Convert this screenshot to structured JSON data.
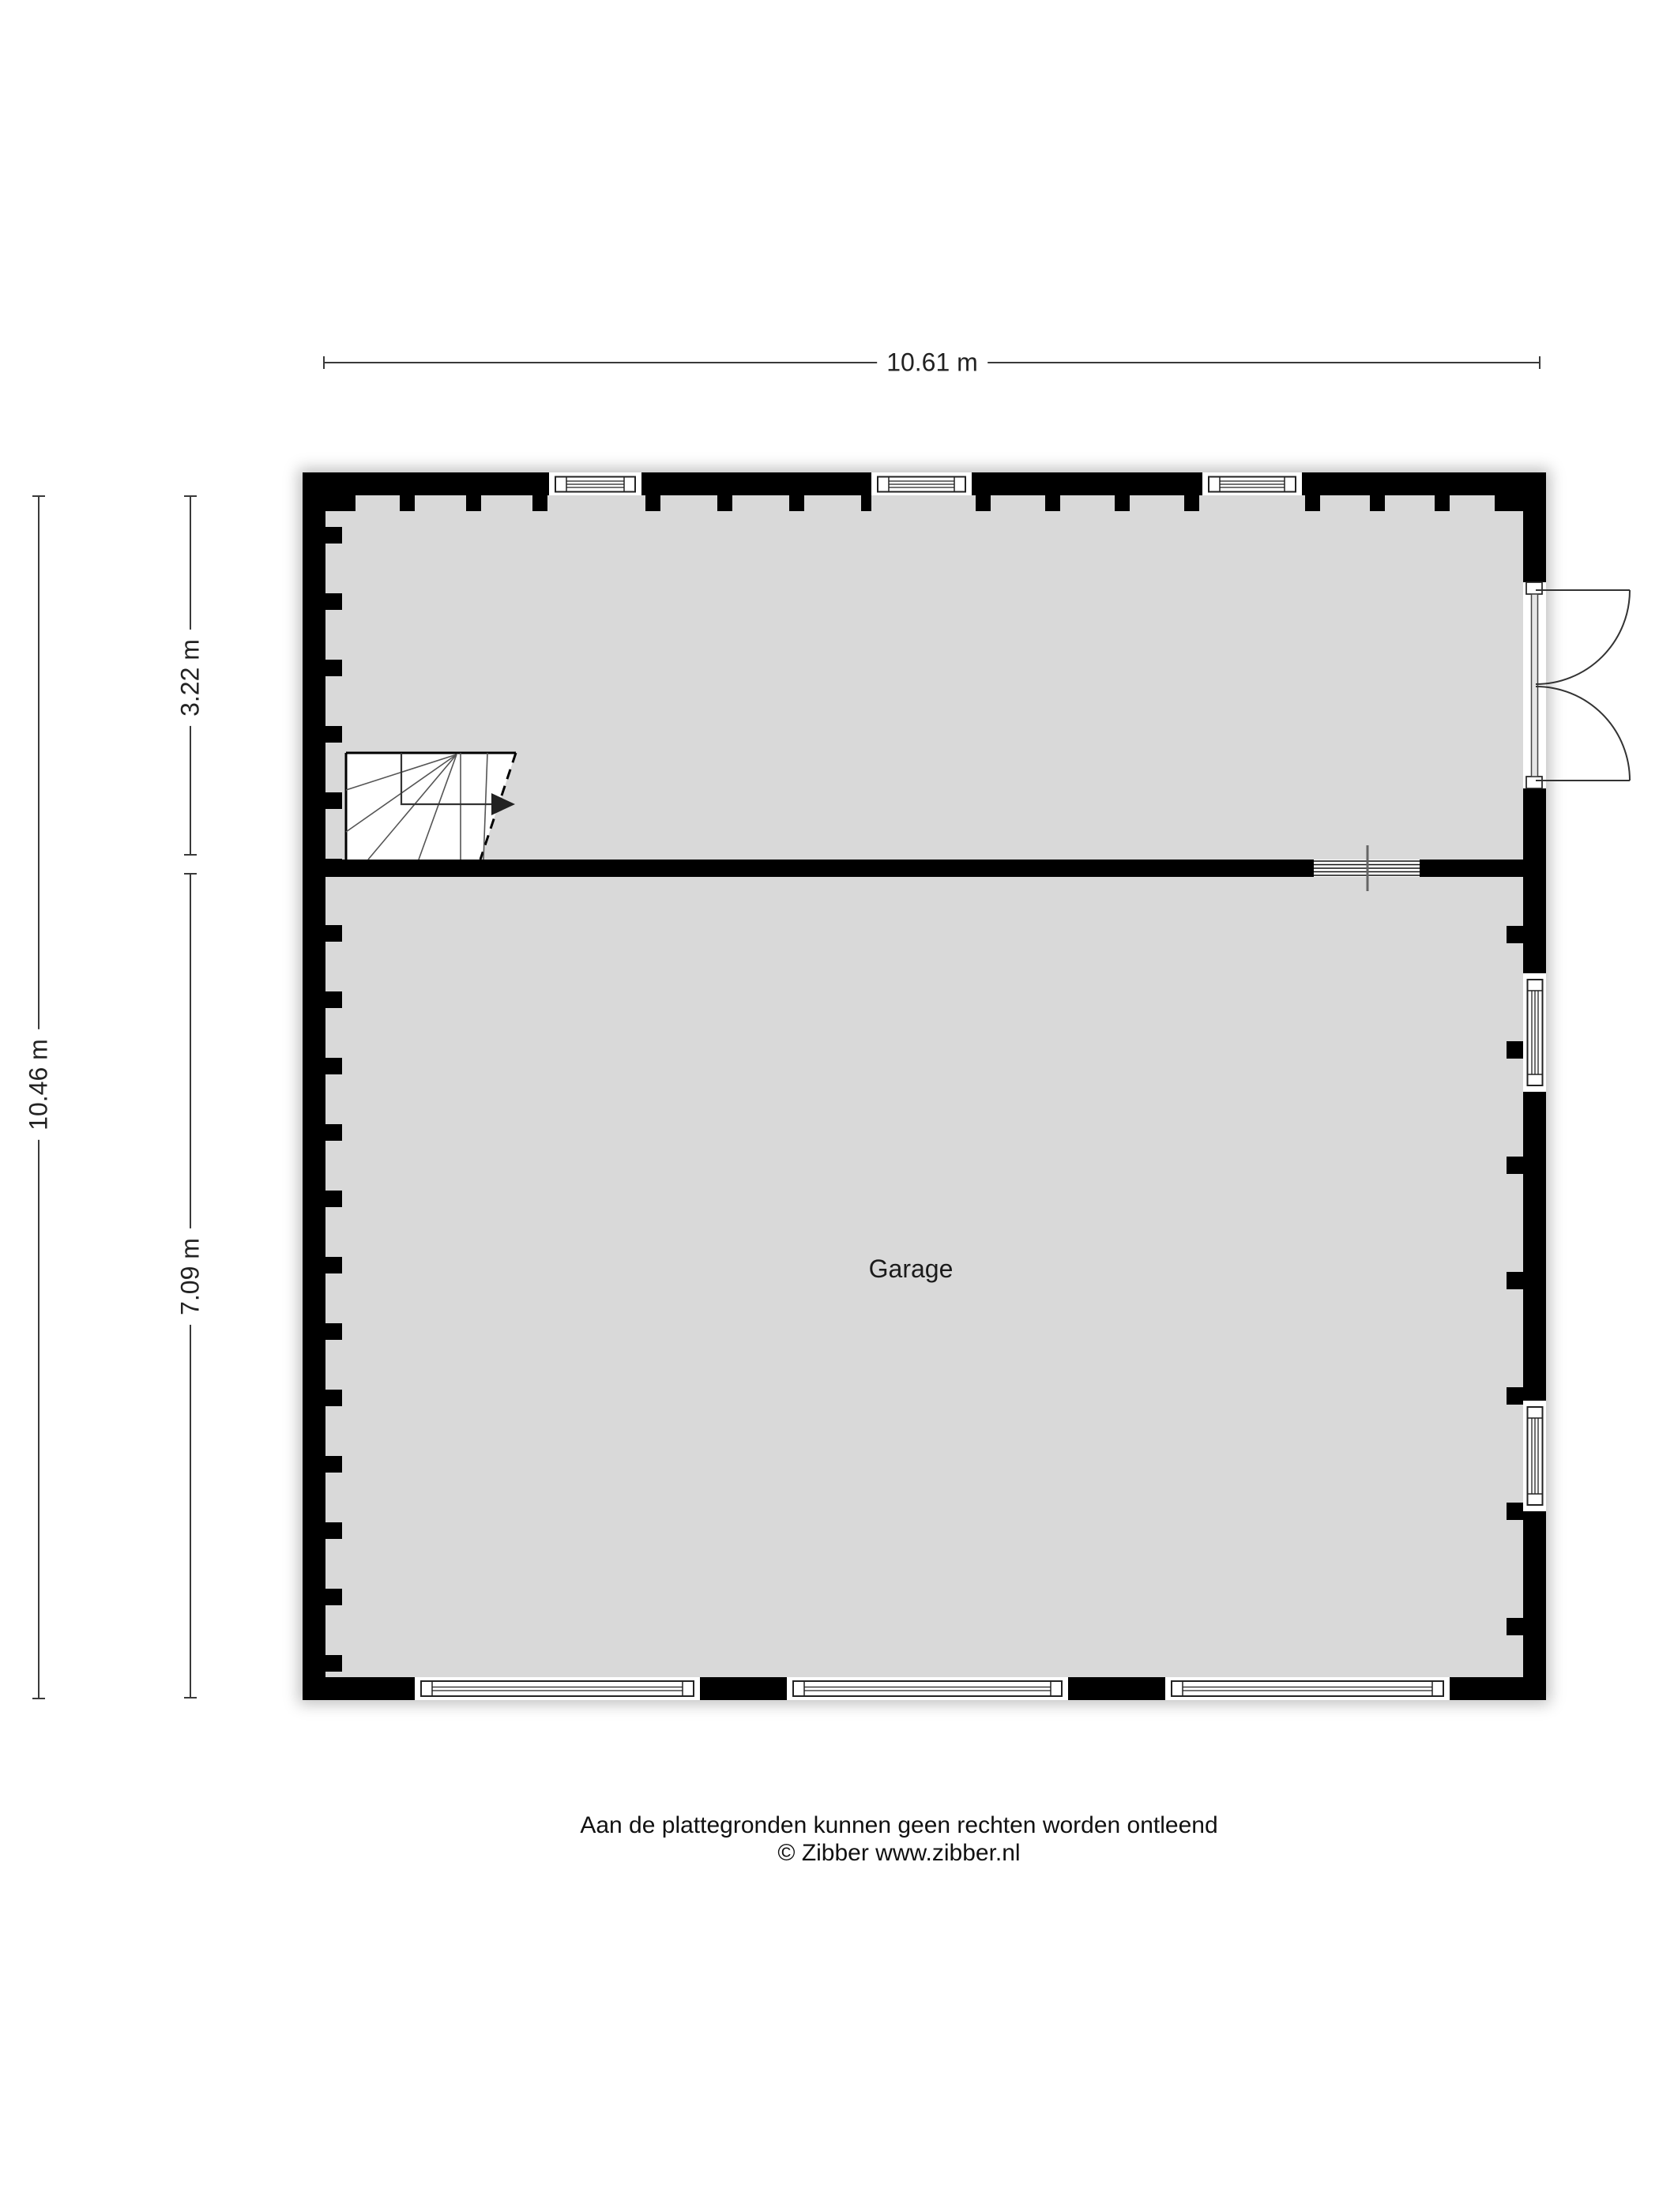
{
  "dimensions": {
    "total_width": "10.61 m",
    "total_height": "10.46 m",
    "upper_room_height": "3.22 m",
    "lower_room_height": "7.09 m"
  },
  "rooms": {
    "garage_label": "Garage"
  },
  "footer": {
    "disclaimer": "Aan de plattegronden kunnen geen rechten worden ontleend",
    "copyright": "© Zibber www.zibber.nl"
  },
  "colors": {
    "wall": "#000000",
    "floor": "#d9d9d9",
    "dimension_line": "#3a3a3a",
    "background": "#ffffff"
  }
}
